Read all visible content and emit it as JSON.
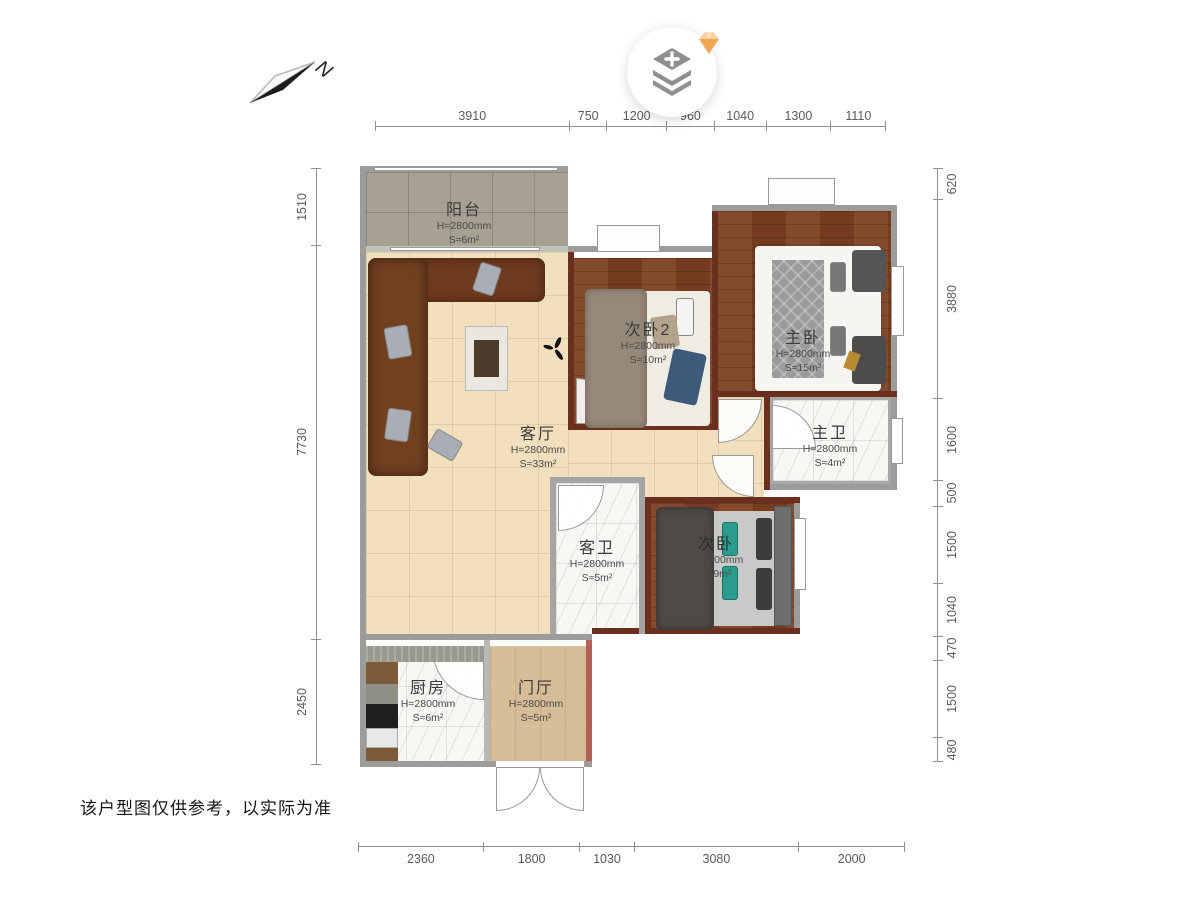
{
  "meta": {
    "disclaimer": "该户型图仅供参考，以实际为准"
  },
  "compass": {
    "label": "N"
  },
  "action_button": {
    "icon": "layers-add-icon",
    "badge_icon": "gem-icon"
  },
  "dimensions": {
    "top": {
      "values": [
        "3910",
        "750",
        "1200",
        "960",
        "1040",
        "1300",
        "1110"
      ]
    },
    "bottom": {
      "values": [
        "2360",
        "1800",
        "1030",
        "3080",
        "2000"
      ]
    },
    "left": {
      "values": [
        "1510",
        "7730",
        "2450"
      ]
    },
    "right": {
      "values": [
        "620",
        "3880",
        "1600",
        "500",
        "1500",
        "1040",
        "470",
        "1500",
        "480"
      ]
    }
  },
  "rooms": {
    "balcony": {
      "name": "阳台",
      "height": "H=2800mm",
      "area": "S≈6m²"
    },
    "living": {
      "name": "客厅",
      "height": "H=2800mm",
      "area": "S≈33m²"
    },
    "bedroom2": {
      "name": "次卧2",
      "height": "H=2800mm",
      "area": "S≈10m²"
    },
    "master": {
      "name": "主卧",
      "height": "H=2800mm",
      "area": "S≈15m²"
    },
    "master_bath": {
      "name": "主卫",
      "height": "H=2800mm",
      "area": "S≈4m²"
    },
    "guest_bath": {
      "name": "客卫",
      "height": "H=2800mm",
      "area": "S≈5m²"
    },
    "bedroom": {
      "name": "次卧",
      "height": "H=2800mm",
      "area": "S≈9m²"
    },
    "kitchen": {
      "name": "厨房",
      "height": "H=2800mm",
      "area": "S≈6m²"
    },
    "foyer": {
      "name": "门厅",
      "height": "H=2800mm",
      "area": "S≈5m²"
    }
  },
  "colors": {
    "wall_interior": "#6b2f1f",
    "wall_outer": "#9c9c9a",
    "badge": "#f3b05a"
  }
}
